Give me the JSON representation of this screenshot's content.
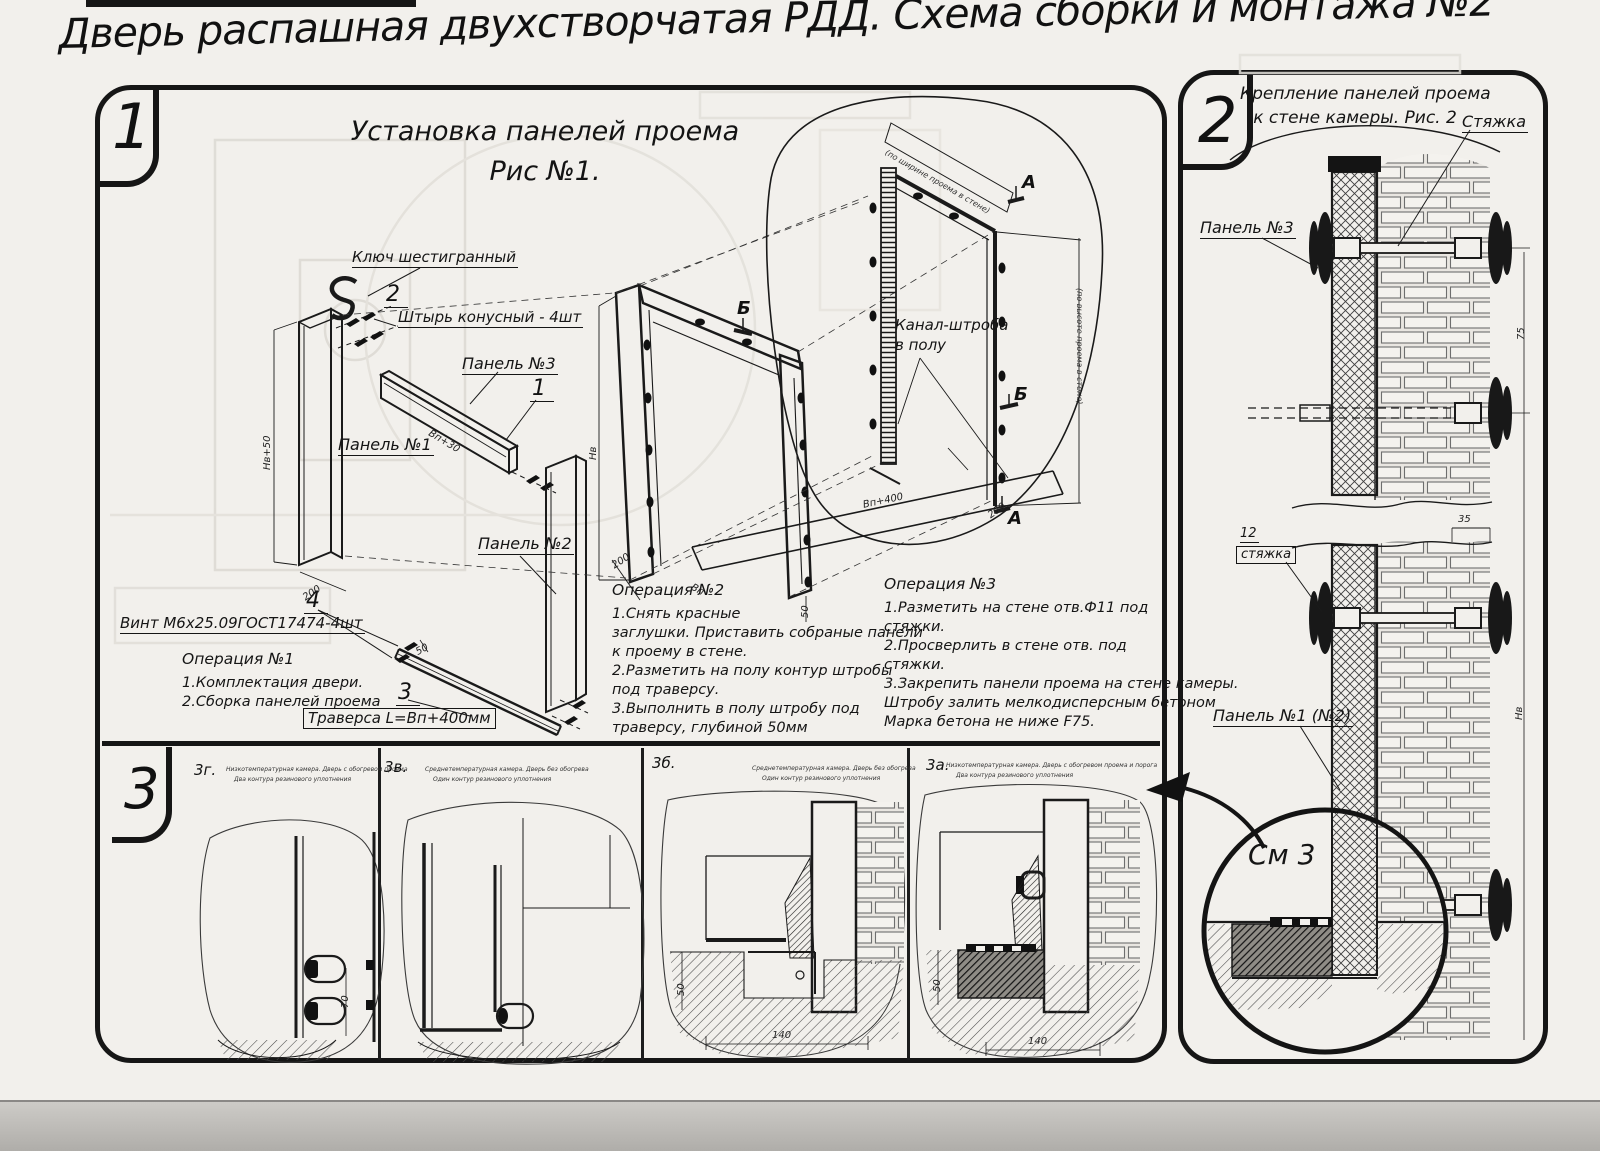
{
  "title": "Дверь распашная двухстворчатая РДД.  Схема сборки и монтажа №2",
  "section1": {
    "number": "1",
    "fig_title": "Установка панелей проема",
    "fig_subtitle": "Рис №1.",
    "labels": {
      "hex_key": "Ключ шестигранный",
      "pin": "Штырь конусный - 4шт",
      "panel3": "Панель №3",
      "panel1": "Панель №1",
      "panel2": "Панель №2",
      "screw": "Винт М6х25.09ГОСТ17474-4шт",
      "traverse": "Траверса  L=Вп+400мм",
      "channel_line1": "Канал-штроба",
      "channel_line2": "в полу",
      "callout1": "1",
      "callout2": "2",
      "callout3": "3",
      "callout4": "4",
      "marker_a": "А",
      "marker_b": "Б"
    },
    "op1": {
      "title": "Операция №1",
      "lines": [
        "1.Комплектация двери.",
        "2.Сборка панелей проема"
      ]
    },
    "op2": {
      "title": "Операция №2",
      "lines": [
        "1.Снять красные",
        "заглушки. Приставить собраные панели",
        "к проему в стене.",
        "2.Разметить на полу контур штробы",
        "под траверсу.",
        "3.Выполнить в полу штробу под",
        "траверсу, глубиной 50мм"
      ]
    },
    "op3": {
      "title": "Операция №3",
      "lines": [
        "1.Разметить на стене отв.Ф11 под",
        "стяжки.",
        "2.Просверлить в стене отв.  под",
        "стяжки.",
        "3.Закрепить панели проема на стене камеры.",
        "Штробу залить мелкодисперсным бетоном",
        "Марка бетона не ниже  F75."
      ]
    },
    "dims": {
      "nv50": "Нв+50",
      "d200": "200",
      "vp30": "Вп+30",
      "nv": "Нв",
      "d200b": "200",
      "vp": "Вп",
      "d50": "50",
      "vp400": "Вп+400",
      "d200c": "200",
      "d50b": "50",
      "width_note": "(по ширине проема в стене)",
      "height_note": "(по высоте проема в стене)"
    }
  },
  "section2": {
    "number": "2",
    "title_line1": "Крепление панелей проема",
    "title_line2": "к стене камеры. Рис. 2",
    "labels": {
      "tie": "Стяжка",
      "panel3": "Панель №3",
      "item12": "12",
      "item12_name": "стяжка",
      "panel12": "Панель №1 (№2)",
      "see3": "См 3"
    },
    "dims": {
      "d35": "35",
      "d75": "75",
      "nv": "Нв"
    }
  },
  "section3": {
    "number": "3",
    "figures": [
      {
        "id": "3г.",
        "cap1": "Низкотемпературная камера. Дверь с обогревом проема",
        "cap2": "Два контура резинового уплотнения"
      },
      {
        "id": "3в.",
        "cap1": "Среднетемпературная камера. Дверь без обогрева",
        "cap2": "Один контур резинового уплотнения"
      },
      {
        "id": "3б.",
        "cap1": "Среднетемпературная камера. Дверь без обогрева",
        "cap2": "Один контур резинового уплотнения"
      },
      {
        "id": "3а.",
        "cap1": "Низкотемпературная камера. Дверь с обогревом проема и порога",
        "cap2": "Два контура резинового уплотнения"
      }
    ],
    "dims": {
      "d70": "70",
      "d50": "50",
      "d140": "140",
      "d50b": "50",
      "d140b": "140"
    }
  }
}
